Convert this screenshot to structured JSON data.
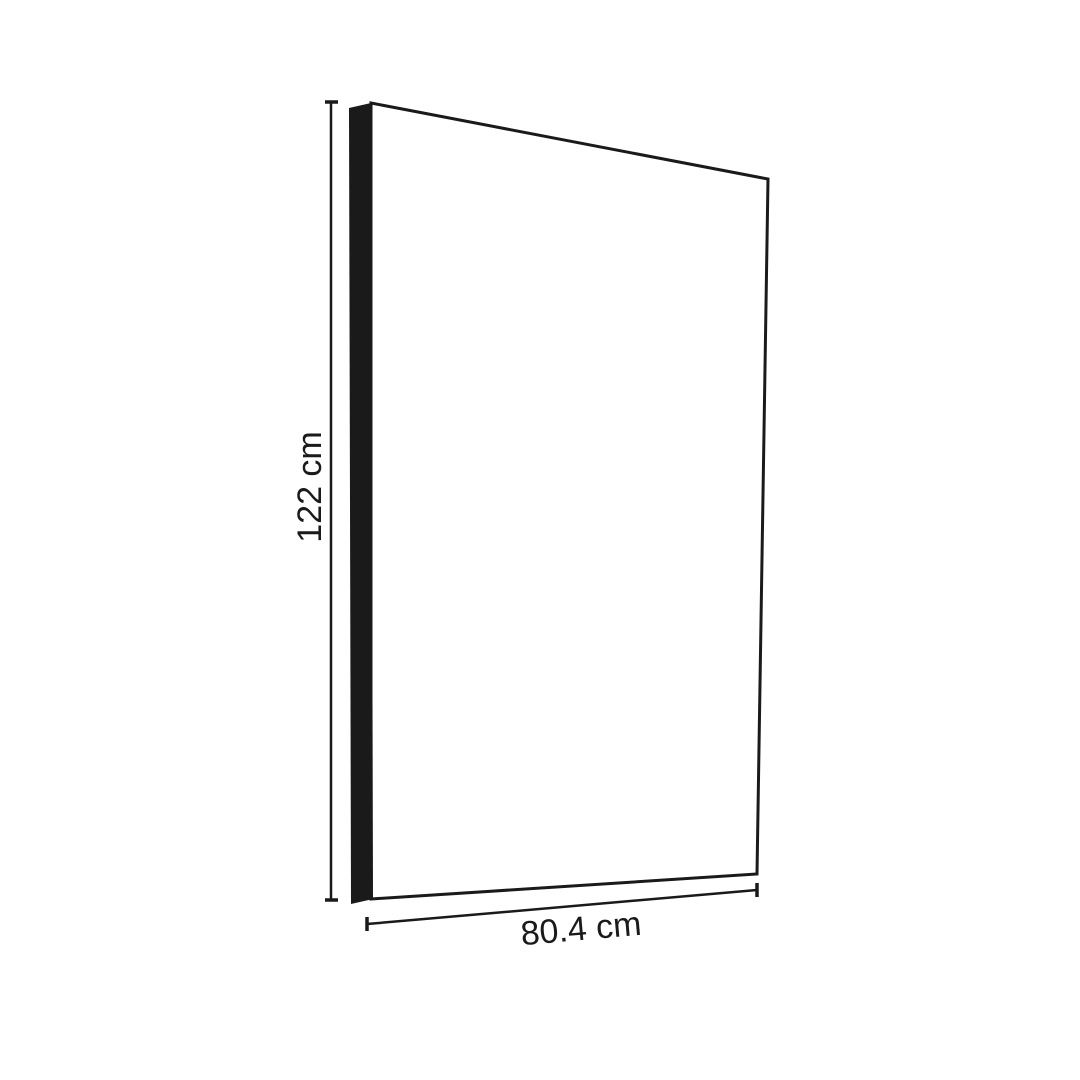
{
  "page": {
    "background": "#ffffff"
  },
  "diagram": {
    "kind": "panel-dimension-drawing",
    "colors": {
      "line": "#1a1a1a",
      "edge_fill": "#1a1a1a",
      "face_fill": "#ffffff"
    },
    "dimensions": {
      "height": {
        "label": "122 cm",
        "value": 122,
        "unit": "cm"
      },
      "width": {
        "label": "80.4 cm",
        "value": 80.4,
        "unit": "cm"
      }
    }
  }
}
